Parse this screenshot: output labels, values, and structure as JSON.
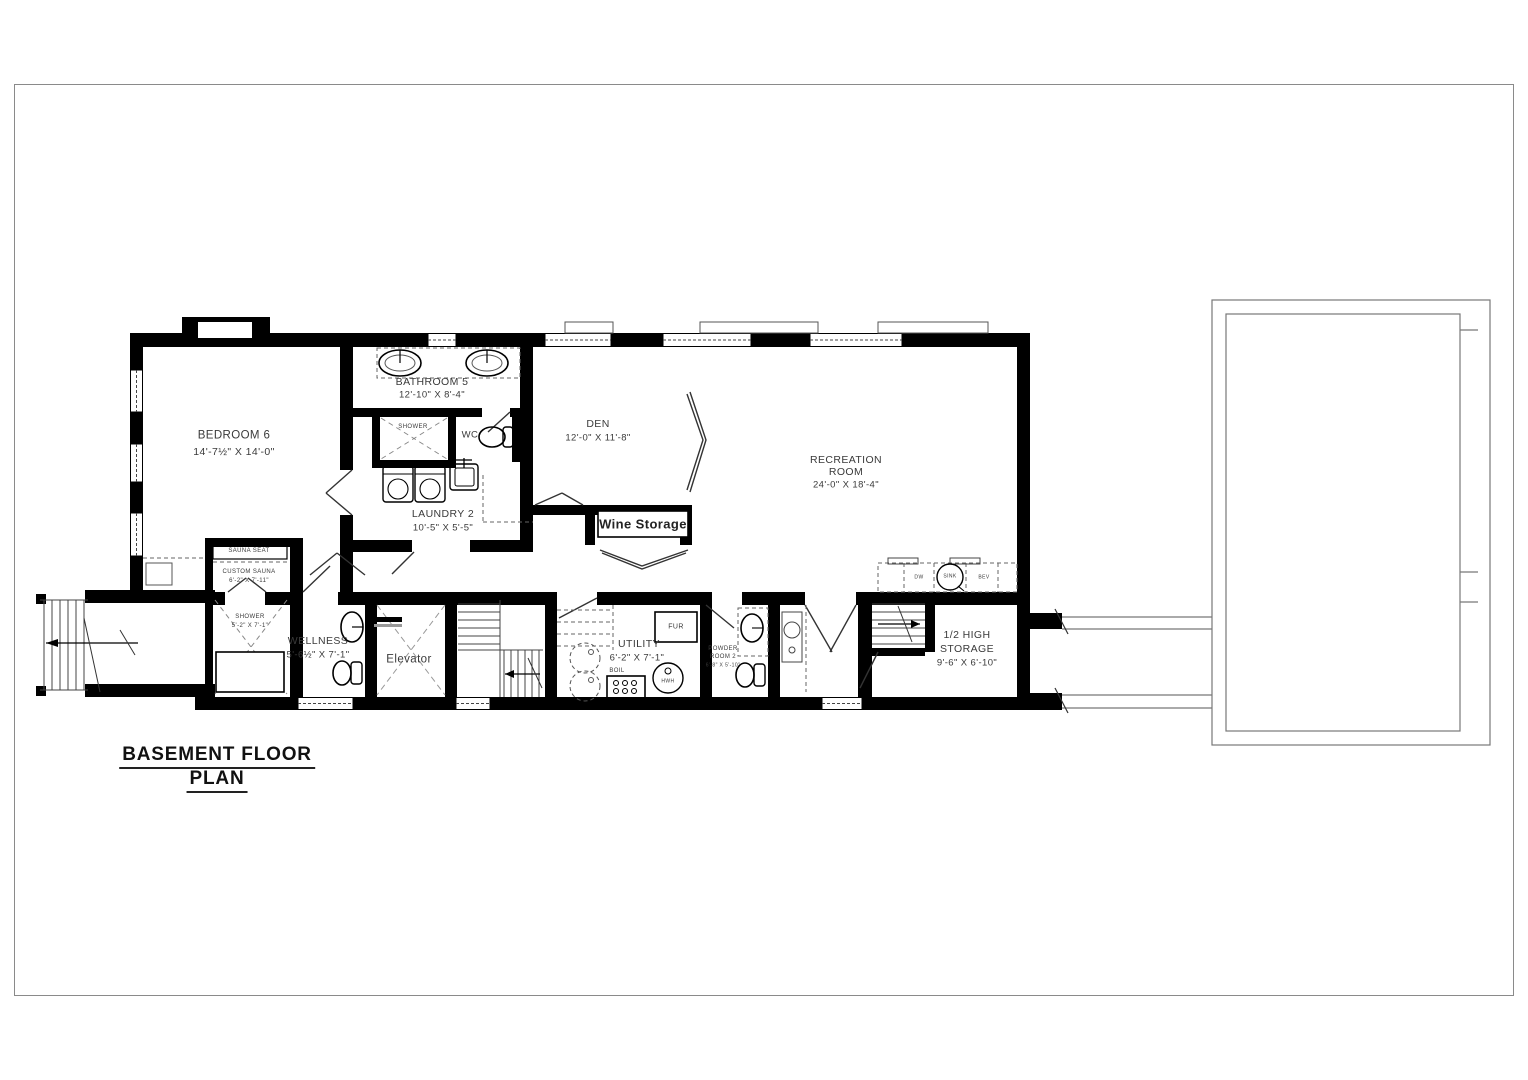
{
  "title": {
    "line1": "BASEMENT FLOOR",
    "line2": "PLAN"
  },
  "rooms": {
    "bedroom6": {
      "name": "BEDROOM 6",
      "dims": "14'-7½\" X 14'-0\""
    },
    "bathroom5": {
      "name": "BATHROOM 5",
      "dims": "12'-10\" X 8'-4\""
    },
    "bath_shower": {
      "name": "SHOWER"
    },
    "wc": {
      "name": "WC"
    },
    "laundry2": {
      "name": "LAUNDRY 2",
      "dims": "10'-5\" X 5'-5\""
    },
    "den": {
      "name": "DEN",
      "dims": "12'-0\" X 11'-8\""
    },
    "wine_storage": {
      "name": "Wine Storage"
    },
    "recreation": {
      "line1": "RECREATION",
      "line2": "ROOM",
      "dims": "24'-0\" X 18'-4\""
    },
    "sauna_seat": {
      "name": "SAUNA SEAT"
    },
    "custom_sauna": {
      "name": "CUSTOM SAUNA",
      "dims": "6'-2\" X 7'-11\""
    },
    "wellness_shower": {
      "name": "SHOWER",
      "dims": "5'-2\" X 7'-1\""
    },
    "wellness": {
      "name": "WELLNESS",
      "dims": "5'-6½\" X 7'-1\""
    },
    "elevator": {
      "name": "Elevator"
    },
    "utility": {
      "name": "UTILITY",
      "dims": "6'-2\" X 7'-1\""
    },
    "powder_room2": {
      "line1": "POWDER",
      "line2": "ROOM 2",
      "dims": "6'-8\" X 5'-10\""
    },
    "half_high_storage": {
      "line1": "1/2 HIGH",
      "line2": "STORAGE",
      "dims": "9'-6\" X 6'-10\""
    }
  },
  "fixtures": {
    "fur": "FUR",
    "boil": "BOIL",
    "hwh": "HWH",
    "dw": "DW",
    "sink": "SINK",
    "bev": "BEV"
  },
  "colors": {
    "wall": "#000000",
    "thin_line": "#555555",
    "background": "#ffffff"
  }
}
